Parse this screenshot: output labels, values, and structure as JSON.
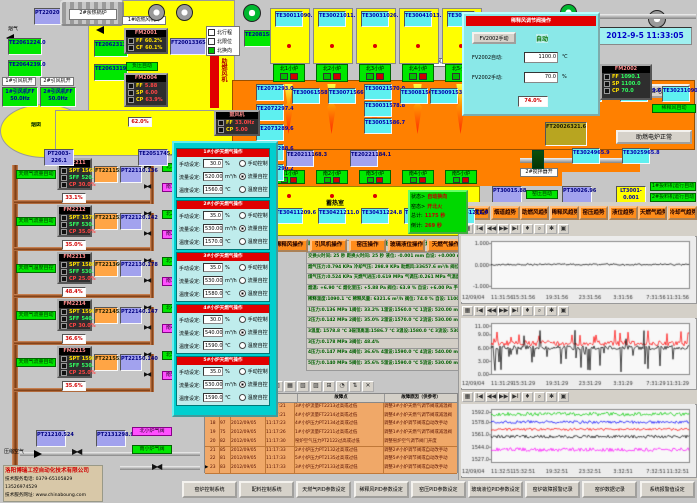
{
  "datetime": "2012-9-5 11:33:05",
  "top_left": {
    "flue_gas_label": "烟气",
    "soft_water_label": "软化水",
    "chimney_label": "烟囱",
    "pt2202": {
      "name": "PT2202",
      "value": "0.794"
    },
    "boilers": [
      {
        "label": "1#余热锅炉"
      },
      {
        "label": "2#余热锅炉"
      }
    ],
    "te_boxes": [
      {
        "name": "TE2061",
        "value": "224.0",
        "x": 8,
        "y": 38
      },
      {
        "name": "TE2064",
        "value": "239.0",
        "x": 8,
        "y": 60
      },
      {
        "name": "TE2062",
        "value": "313.0",
        "x": 94,
        "y": 40
      },
      {
        "name": "TE2063",
        "value": "319.0",
        "x": 94,
        "y": 64
      }
    ],
    "fan_run_labels": [
      {
        "text": "1#引风机开",
        "x": 2,
        "y": 77,
        "w": 34
      },
      {
        "text": "2#引风机开",
        "x": 40,
        "y": 77,
        "w": 34
      },
      {
        "text": "1#助燃风机开",
        "x": 122,
        "y": 16,
        "w": 44
      },
      {
        "text": "2#稀释风机开",
        "x": 514,
        "y": 58,
        "w": 40
      },
      {
        "text": "1#碎玻璃风机开",
        "x": 410,
        "y": 58,
        "w": 46
      }
    ],
    "id_fans": [
      {
        "label": "1#引风机",
        "ff": "FF 50.0Hz",
        "x": 2,
        "y": 87
      },
      {
        "label": "2#引风机",
        "ff": "FF 50.0Hz",
        "x": 40,
        "y": 87
      }
    ],
    "fm2001": {
      "title": "FM2001",
      "rows": [
        {
          "k": "FF",
          "v": "60.2%",
          "c": "cY"
        },
        {
          "k": "CF",
          "v": "60.1%",
          "c": "cR"
        }
      ]
    },
    "ft2001": {
      "name": "FT2001",
      "value": "33657.6"
    },
    "legend": {
      "items": [
        {
          "text": "北行程",
          "on": false
        },
        {
          "text": "北限位",
          "on": false
        },
        {
          "text": "北换向",
          "on": true
        }
      ]
    },
    "neg_pressure_auto": "负压自动",
    "fm2004": {
      "title": "FM2004",
      "rows": [
        {
          "k": "FF",
          "v": "5.88",
          "c": "cY"
        },
        {
          "k": "SP",
          "v": "6.00",
          "c": "cG"
        },
        {
          "k": "CP",
          "v": "63.9%",
          "c": "cR"
        }
      ]
    },
    "fan_bar_label": "助燃风机",
    "blower": {
      "title": "鼓风机",
      "rows": [
        {
          "k": "FF",
          "v": "33.0Hz",
          "c": "cY"
        },
        {
          "k": "CP",
          "v": "5.00",
          "c": "cR"
        }
      ]
    },
    "pt2003": {
      "name": "PT2003",
      "value": "-226.1"
    },
    "te2051": {
      "name": "TE2051",
      "value": "745.7"
    },
    "damper_pos": "62.0%"
  },
  "dilution_popup": {
    "header": "稀释风调节阀操作",
    "manual_btn": "FV2002手动",
    "auto_status": "自动",
    "rows": [
      {
        "label": "FV2002自动:",
        "value": "1100.0",
        "unit": "℃"
      },
      {
        "label": "FV2002手动:",
        "value": "70.0",
        "unit": "%"
      }
    ]
  },
  "top_right": {
    "valve_pos": "74.0%",
    "ft2002": {
      "name": "FT2002",
      "value": "6321.6"
    },
    "fm2002": {
      "title": "FM2002",
      "rows": [
        {
          "k": "FF",
          "v": "1090.1",
          "c": "cY"
        },
        {
          "k": "SP",
          "v": "1100.0",
          "c": "cG"
        },
        {
          "k": "CP",
          "v": "70.0",
          "c": "cR"
        }
      ]
    },
    "dilution_auto": "稀释风自动",
    "buttons": [
      {
        "text": "试验电炉",
        "x": 622,
        "y": 84,
        "w": 68
      },
      {
        "text": "助燃电炉正常",
        "x": 616,
        "y": 130,
        "w": 76
      }
    ]
  },
  "furnace": {
    "regen_label_north": "蓄热室",
    "regen_label_south": "蓄热室",
    "te2081": {
      "name": "TE2081",
      "value": "585.0"
    },
    "north_ports": [
      {
        "x": 270,
        "label": "北1小炉",
        "te": "TE3001",
        "tv": "1090.1"
      },
      {
        "x": 313,
        "label": "北2小炉",
        "te": "TE3002",
        "tv": "1011.7"
      },
      {
        "x": 356,
        "label": "北3小炉",
        "te": "TE3003",
        "tv": "1026.1"
      },
      {
        "x": 399,
        "label": "北4小炉",
        "te": "TE3004",
        "tv": "1013.3"
      },
      {
        "x": 442,
        "label": "北5小炉",
        "te": "TE3005",
        "tv": "1051.7"
      }
    ],
    "south_ports": [
      {
        "x": 270,
        "label": "南1小炉",
        "te": "TE3041",
        "tv": "1209.6"
      },
      {
        "x": 313,
        "label": "南2小炉",
        "te": "TE3042",
        "tv": "1211.0"
      },
      {
        "x": 356,
        "label": "南3小炉",
        "te": "TE3043",
        "tv": "1224.8"
      },
      {
        "x": 399,
        "label": "南4小炉",
        "te": "TE3044",
        "tv": "1212.6"
      },
      {
        "x": 442,
        "label": "南5小炉",
        "te": "TE3045",
        "tv": "1211.0"
      }
    ],
    "left_stack": [
      {
        "name": "TE2071",
        "value": "293.0"
      },
      {
        "name": "TE2072",
        "value": "297.4"
      },
      {
        "name": "TE2073",
        "value": "289.6"
      },
      {
        "name": "TE2074",
        "value": "288.6"
      },
      {
        "name": "TE2075",
        "value": "290.2"
      }
    ],
    "crown_temps": [
      {
        "name": "TE3006",
        "value": "1558.0",
        "x": 292,
        "y": 88
      },
      {
        "name": "TE3007",
        "value": "1566.2",
        "x": 328,
        "y": 88
      },
      {
        "name": "TE3002",
        "value": "1570.0",
        "x": 364,
        "y": 84
      },
      {
        "name": "TE3003",
        "value": "1578.8",
        "x": 364,
        "y": 101
      },
      {
        "name": "TE3005",
        "value": "1586.7",
        "x": 364,
        "y": 118
      },
      {
        "name": "TE3008",
        "value": "1567.5",
        "x": 400,
        "y": 88
      },
      {
        "name": "TE3009",
        "value": "1538.5",
        "x": 430,
        "y": 88
      },
      {
        "name": "TE3010",
        "value": "1523.8",
        "x": 466,
        "y": 88
      }
    ],
    "right_temps": [
      {
        "name": "TE3021",
        "value": "1090.1",
        "x": 574,
        "y": 86
      },
      {
        "name": "TE3022",
        "value": "1079.6",
        "x": 620,
        "y": 86
      },
      {
        "name": "TE3023",
        "value": "1090.1",
        "x": 662,
        "y": 86
      },
      {
        "name": "TE3024",
        "value": "965.9",
        "x": 572,
        "y": 148
      },
      {
        "name": "TE3025",
        "value": "965.8",
        "x": 622,
        "y": 148
      }
    ],
    "te2021": {
      "name": "TE2021",
      "value": "1168.3"
    },
    "te2022": {
      "name": "TE2022",
      "value": "1184.1"
    },
    "stirrer_labels": [
      {
        "text": "1#搅拌器开",
        "x": 520,
        "y": 73
      },
      {
        "text": "2#搅拌器开",
        "x": 520,
        "y": 168
      }
    ],
    "status_panel": {
      "lines": [
        {
          "k": "状态>",
          "v": "自动换向"
        },
        {
          "k": "窑态>",
          "v": "开北火"
        },
        {
          "k": "总计:",
          "v": "1175 秒"
        },
        {
          "k": "倒计:",
          "v": "269 秒"
        }
      ]
    }
  },
  "gas_lines": [
    {
      "y": 158,
      "fm": "FM2211",
      "spt": "1560.0",
      "sff": "520.00",
      "cp": "30.0%",
      "mode": "天燃气流量自动",
      "modeCls": "glb",
      "pct": "33.1%",
      "ft": "FT2211",
      "ftv": "557.04",
      "pt": "PT2211",
      "ptv": "0.136",
      "nv": "北1天然气开",
      "sv": "南1天然气开"
    },
    {
      "y": 205,
      "fm": "FM2212",
      "spt": "1570.0",
      "sff": "530.00",
      "cp": "35.0%",
      "mode": "天燃气流量自动",
      "modeCls": "glb",
      "pct": "35.0%",
      "ft": "FT2212",
      "ftv": "522.89",
      "pt": "PT2212",
      "ptv": "0.142",
      "nv": "北2天然气开",
      "sv": "南2天然气开"
    },
    {
      "y": 252,
      "fm": "FM2213",
      "spt": "1580.0",
      "sff": "530.00",
      "cp": "25.0%",
      "mode": "天燃气温度自控",
      "modeCls": "glb ylb",
      "pct": "48.4%",
      "ft": "FT2213",
      "ftv": "605.19",
      "pt": "PT2213",
      "ptv": "0.178",
      "nv": "北3天然气开",
      "sv": "南3天然气开"
    },
    {
      "y": 299,
      "fm": "FM2214",
      "spt": "1590.0",
      "sff": "540.00",
      "cp": "30.0%",
      "mode": "天燃气流量自动",
      "modeCls": "glb",
      "pct": "36.6%",
      "ft": "FT2214",
      "ftv": "532.44",
      "pt": "PT2214",
      "ptv": "0.147",
      "nv": "北4天然气开",
      "sv": "南4天然气开"
    },
    {
      "y": 346,
      "fm": "FM2215",
      "spt": "1590.0",
      "sff": "530.00",
      "cp": "25.0%",
      "mode": "天燃气流量自动",
      "modeCls": "glb",
      "pct": "35.6%",
      "ft": "FT2215",
      "ftv": "534.58",
      "pt": "PT2215",
      "ptv": "0.140",
      "nv": "北5天然气开",
      "sv": "南5天然气开"
    }
  ],
  "burner_popup": {
    "field_labels": [
      "手动设定:",
      "流量设定:",
      "温度设定:"
    ],
    "units": [
      "%",
      "m³/h",
      "℃"
    ],
    "radio_labels": [
      "手动控制",
      "流量自控",
      "温度自控"
    ],
    "sections": [
      {
        "y": 148,
        "title": "1#小炉天燃气操作",
        "manual": "30.0",
        "flow": "520.00",
        "temp": "1560.0",
        "sel": 1
      },
      {
        "y": 200,
        "title": "2#小炉天燃气操作",
        "manual": "35.0",
        "flow": "530.00",
        "temp": "1570.0",
        "sel": 1
      },
      {
        "y": 252,
        "title": "3#小炉天燃气操作",
        "manual": "35.0",
        "flow": "530.00",
        "temp": "1580.0",
        "sel": 2
      },
      {
        "y": 304,
        "title": "4#小炉天燃气操作",
        "manual": "30.0",
        "flow": "540.00",
        "temp": "1590.0",
        "sel": 1
      },
      {
        "y": 356,
        "title": "5#小炉天燃气操作",
        "manual": "35.0",
        "flow": "530.00",
        "temp": "1590.0",
        "sel": 1
      }
    ]
  },
  "center_readout": {
    "top": "助燃风量:33657.6 m³/h   天燃气总流量:2683.4 m³/h   空燃比: 12.5:1   气累积量: 134057.7",
    "rows": [
      "交换火时间: 25 秒  距换火时间: 25 秒  液位: -0.001 mm  自设: +0.000 mm  1手设:50.0% 自动 2手设:50.0% 自动",
      "烟气压力:0.794 KPa  冷却气压: 298.9 KPa  助燃风:33657.6 m³/h  阀位: 60.2%  设定: 60.0%",
      "煤气压力:0.524 KPa  天燃气进压:0.619 MPa  气调压:0.261 MPa  气温度: 19.6 ℃",
      "烟温: +6.90 ℃  烟化室压: +5.88 Pa  阀位: 63.9 %  自设: +6.00 Pa  手设: 70.0%  自动",
      "稀释温度:1090.1 ℃  稀释风量: 6321.6 m³/h  阀位: 74.0 %  自设: 1100.0 ℃  手设: 70.0%  自动",
      "1压力:0.136 MPa  1阀位: 33.2%  1温设:1560.0 ℃  1流设: 520.00 m³/h  1手设: 30.0%  流控",
      "2压力:0.142 MPa  2阀位: 35.0%  2温设:1570.0 ℃  2流设: 530.00 m³/h  2手设: 35.0%  流控",
      "3温度: 1578.8 ℃  3碹顶高温:1586.7 ℃  3温设:1580.0 ℃  3流设: 530.00 m³/h  3手设: 35.0%  温控",
      "3压力:0.178 MPa  3阀位: 48.4%",
      "4压力:0.147 MPa  4阀位: 36.6%  4温设:1590.0 ℃  4流设: 540.00 m³/h  4手设: 30.0%  流控",
      "5压力:0.140 MPa  5阀位: 35.6%  5温设:1590.0 ℃  5流设: 530.00 m³/h  5手设: 35.0%  流控"
    ]
  },
  "ops_buttons": [
    "助燃风操作",
    "稀释风操作",
    "引风机操作",
    "窑压操作",
    "玻璃液位操作",
    "天燃气操作"
  ],
  "pressure_row": {
    "pt3001": {
      "name": "PT3001",
      "value": "5.88"
    },
    "kiln_auto": "窑压自动",
    "pt3002": {
      "name": "PT3002",
      "value": "6.96"
    },
    "lt3001": {
      "name": "LT3001",
      "value": "-0.001"
    },
    "feeders": [
      "1#投料机运行自动",
      "2#投料机运行自动"
    ]
  },
  "trend_buttons": [
    "窑温度趋势",
    "烟道趋势",
    "助燃风趋势",
    "稀释风趋势",
    "窑压趋势",
    "液位趋势",
    "天燃气趋势",
    "冷却气趋势"
  ],
  "chart_toolbar_icons": [
    "▦",
    "Ⅰ◀",
    "◀◀",
    "▶▶",
    "▶Ⅰ",
    "♦",
    "⌕",
    "✱",
    "▣"
  ],
  "table_toolbar_icons": [
    "▤",
    "☰",
    "?",
    "▥",
    "▦",
    "▧",
    "▨",
    "⊞",
    "◔",
    "⇅",
    "✕"
  ],
  "chart_data": [
    {
      "type": "line",
      "date_label": "12/09/04",
      "x_ticks": [
        "11:31:56",
        "15:31:56",
        "19:31:56",
        "23:31:56",
        "3:31:56",
        "7:31:56",
        "11:31:56"
      ],
      "y_tick_vals": [
        1.0,
        0.0,
        -1.0
      ],
      "y_tick_labels": [
        "1.000",
        "0.000",
        "-1.000"
      ],
      "ylim": [
        -1.1,
        1.1
      ],
      "series": [
        {
          "name": "玻璃液位",
          "color": "#000000",
          "mean": 0.0,
          "amp": 0.04,
          "style": "noise"
        }
      ]
    },
    {
      "type": "line",
      "date_label": "12/09/04",
      "x_ticks": [
        "11:31:29",
        "15:31:29",
        "19:31:29",
        "23:31:29",
        "3:31:29",
        "7:31:29",
        "11:31:29"
      ],
      "y_tick_vals": [
        11.0,
        9.0,
        6.0,
        3.0,
        0.0
      ],
      "y_tick_labels": [
        "11.00",
        "9.00",
        "6.00",
        "3.00",
        "0.00"
      ],
      "ylim": [
        0,
        11.6
      ],
      "series": [
        {
          "name": "窑压设定",
          "color": "#ff0000",
          "mean": 7.0,
          "amp": 0.6,
          "style": "spiky-up"
        },
        {
          "name": "窑压",
          "color": "#000000",
          "mean": 6.0,
          "amp": 0.5,
          "style": "spiky-down"
        }
      ]
    },
    {
      "type": "line",
      "date_label": "12/09/04",
      "x_ticks": [
        "11:32:51",
        "15:32:51",
        "19:32:51",
        "23:32:51",
        "3:32:51",
        "7:32:51",
        "11:32:51"
      ],
      "y_tick_vals": [
        1592.0,
        1578.0,
        1561.0,
        1544.0,
        1527.0
      ],
      "y_tick_labels": [
        "1592.0",
        "1578.0",
        "1561.0",
        "1544.0",
        "1527.0"
      ],
      "ylim": [
        1523,
        1596
      ],
      "series": [
        {
          "name": "1#小炉温度",
          "color": "#00cc00",
          "mean": 1589,
          "amp": 2.5,
          "style": "noise"
        },
        {
          "name": "2#小炉温度",
          "color": "#0000ff",
          "mean": 1578,
          "amp": 2.0,
          "style": "noise"
        },
        {
          "name": "3#小炉温度",
          "color": "#ff0000",
          "mean": 1568,
          "amp": 1.6,
          "style": "noise"
        },
        {
          "name": "4#小炉温度",
          "color": "#000000",
          "mean": 1558,
          "amp": 2.0,
          "style": "noise"
        },
        {
          "name": "5#小炉温度",
          "color": "#ff00ff",
          "mean": 1540,
          "amp": 2.6,
          "style": "noise"
        }
      ]
    }
  ],
  "alarm_table": {
    "headers": [
      "故障点",
      "故障原因（供参考）"
    ],
    "rows": [
      {
        "mark": "",
        "n": "16",
        "c": "98",
        "d": "2012/09/05",
        "t": "11:17:21",
        "f": "3#小炉流量FT2213过高或过低",
        "r": "调整3#小炉天燃气调节阀或减温阀"
      },
      {
        "mark": "",
        "n": "17",
        "c": "96",
        "d": "2012/09/05",
        "t": "11:17:21",
        "f": "4#小炉流量FT2214过高或过低",
        "r": "调整4#小炉天燃气调节阀或减温阀"
      },
      {
        "mark": "",
        "n": "18",
        "c": "97",
        "d": "2012/09/05",
        "t": "11:17:23",
        "f": "4#小炉压力PT2134过高或过低",
        "r": "调整4#小炉调节阀或自动改手动"
      },
      {
        "mark": "",
        "n": "19",
        "c": "75",
        "d": "2012/09/05",
        "t": "11:17:26",
        "f": "1#小炉流量FT2211过高或过低",
        "r": "调整1#小炉天燃气调节阀或减温阀"
      },
      {
        "mark": "",
        "n": "20",
        "c": "82",
        "d": "2012/09/05",
        "t": "11:17:30",
        "f": "窑炉空气压力PT2122过高或过低",
        "r": "调整窑炉空气调节阀门开度"
      },
      {
        "mark": "",
        "n": "21",
        "c": "85",
        "d": "2012/09/05",
        "t": "11:17:33",
        "f": "2#小炉压力PT2132过高或过低",
        "r": "调整2#小炉调节阀或自动改手动"
      },
      {
        "mark": "",
        "n": "22",
        "c": "81",
        "d": "2012/09/05",
        "t": "11:17:33",
        "f": "5#小炉压力PT2135过高或过低",
        "r": "调整5#小炉调节阀或自动改手动"
      },
      {
        "mark": "▶",
        "n": "23",
        "c": "83",
        "d": "2012/09/05",
        "t": "11:17:33",
        "f": "3#小炉压力PT2133过高或过低",
        "r": "调整3#小炉调节阀或自动改手动"
      }
    ]
  },
  "bottom_left": {
    "air_label": "压缩空气",
    "pt2121": {
      "name": "PT2121",
      "value": "0.524"
    },
    "pt2131": {
      "name": "PT2131",
      "value": "298.9"
    },
    "valve_labels": [
      {
        "text": "北小炉气阀",
        "cls": "mlb"
      },
      {
        "text": "南小炉气阀",
        "cls": ""
      }
    ],
    "company": {
      "name": "洛阳博瑞工控自动化技术有限公司",
      "phone": "技术服务电话: 0379-65105829  13526974529",
      "web": "技术服务网址: www.chinaboung.com"
    }
  },
  "bottom_buttons": [
    "窑炉控制系统",
    "配料控制系统",
    "天燃气PID参数设定",
    "稀释风PID参数设定",
    "窑压PID参数设定",
    "玻璃液位PID参数设定",
    "窑炉故障报警记录",
    "窑炉数据记录",
    "系统报警值设定"
  ]
}
